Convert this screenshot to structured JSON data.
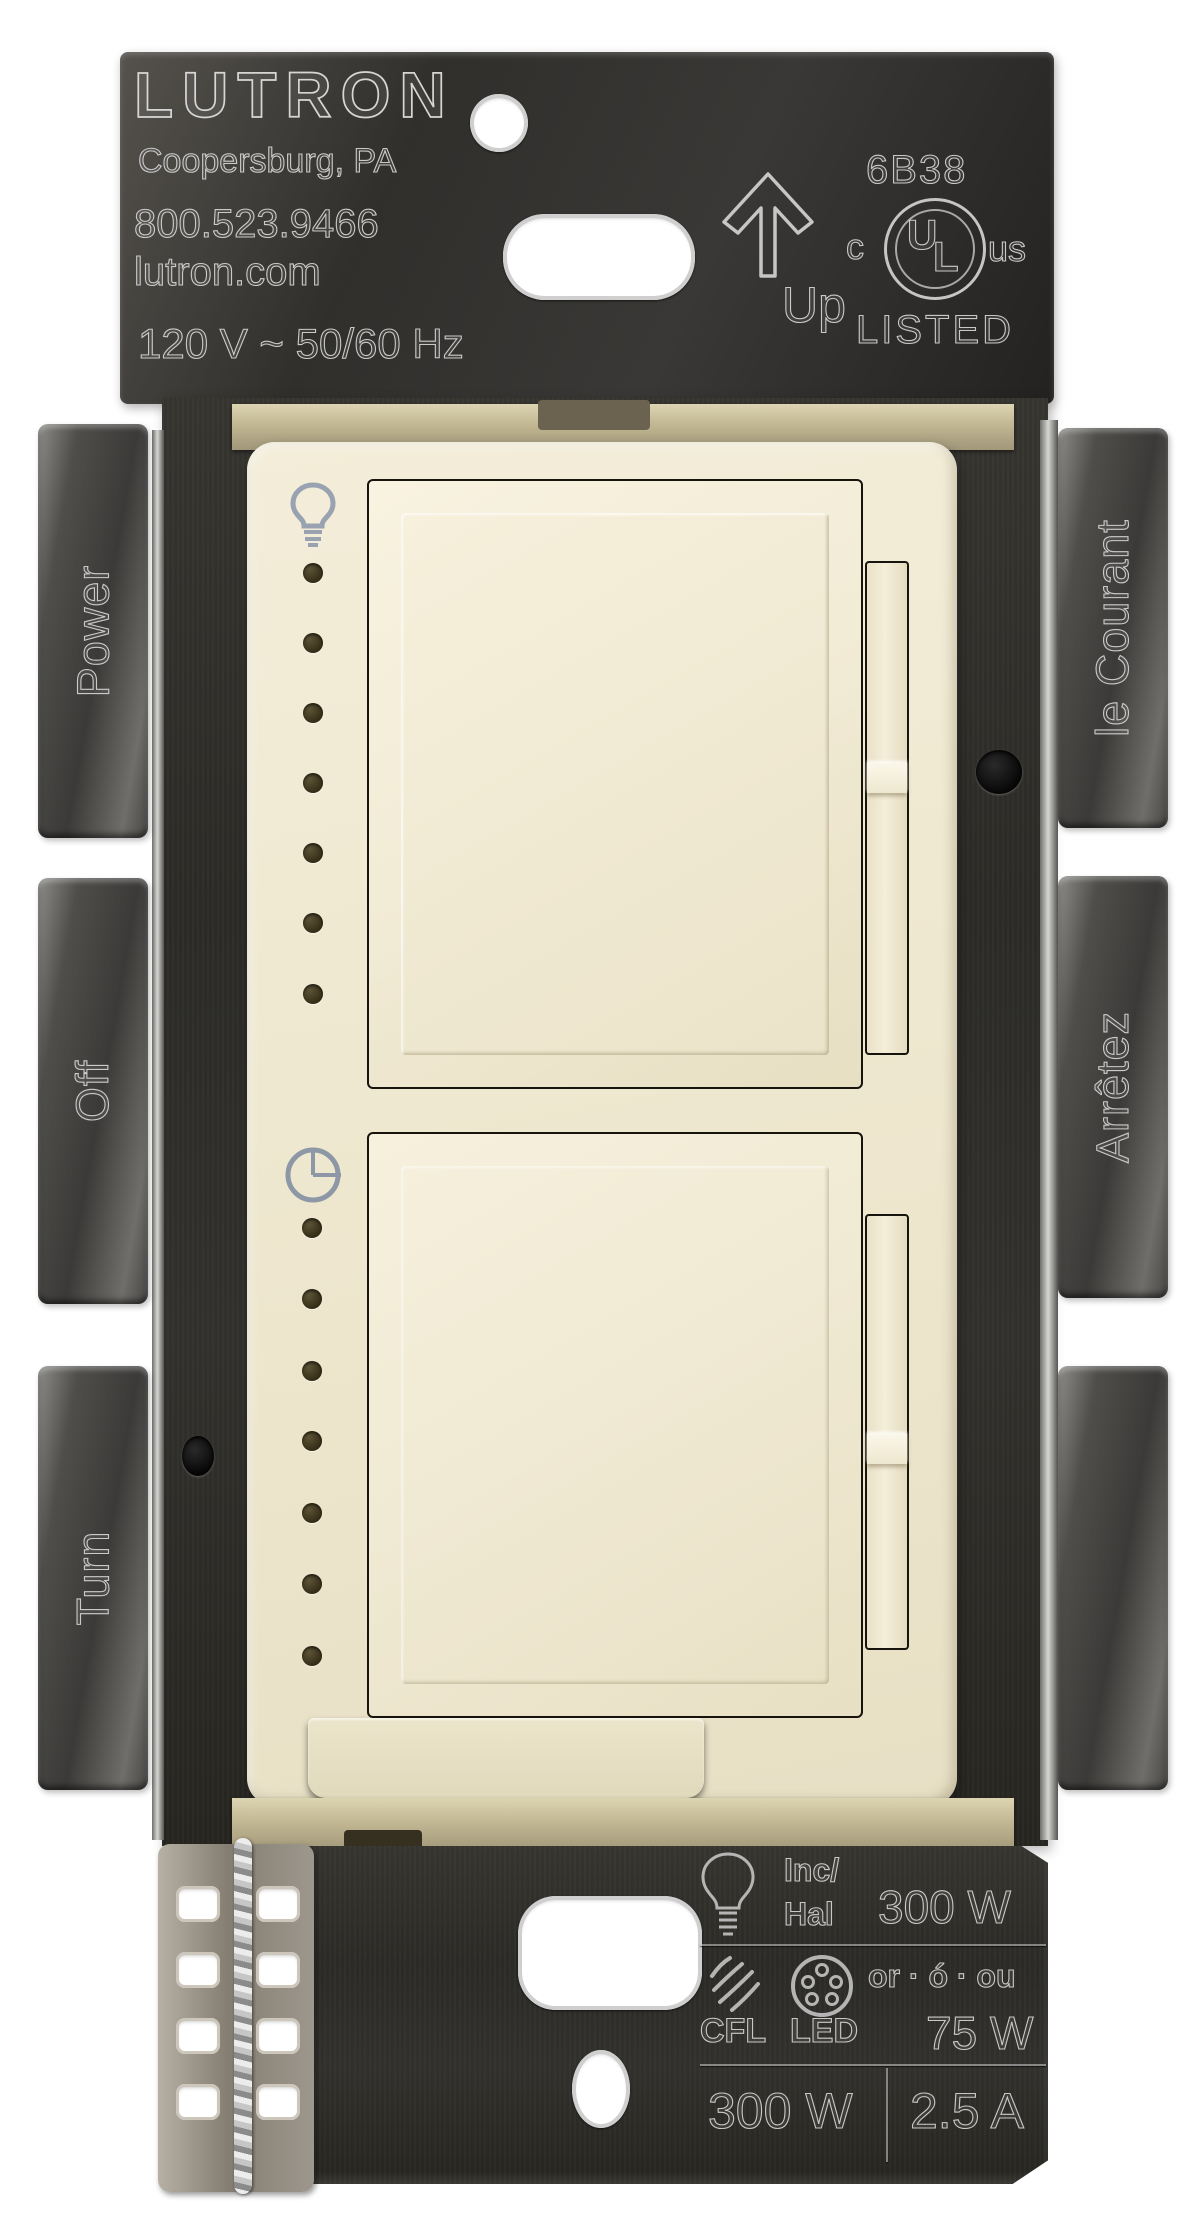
{
  "top_plate": {
    "brand": "LUTRON",
    "address": "Coopersburg, PA",
    "phone": "800.523.9466",
    "website": "lutron.com",
    "electrical_rating": "120 V ~ 50/60 Hz",
    "code": "6B38",
    "orientation_label": "Up",
    "ul_prefix": "c",
    "ul_u": "U",
    "ul_l": "L",
    "ul_suffix": "us",
    "listed": "LISTED"
  },
  "left_tabs": {
    "top": "Power",
    "middle": "Off",
    "bottom": "Turn"
  },
  "right_tabs": {
    "top": "le Courant",
    "middle": "Arrêtez"
  },
  "timer": {
    "labels": [
      "On",
      "60",
      "45",
      "30",
      "15",
      "10",
      "5"
    ]
  },
  "ratings_plate": {
    "inc_line1": "Inc/",
    "inc_line2": "Hal",
    "inc_hal_watts": "300 W",
    "or_text": "or · ó · ou",
    "cfl_label": "CFL",
    "led_label": "LED",
    "cfl_led_watts": "75 W",
    "total_watts": "300 W",
    "max_amps": "2.5 A"
  },
  "icons": {
    "up_arrow": "up-arrow-icon",
    "light_bulb": "light-bulb-icon",
    "timer_clock": "timer-clock-icon",
    "inc_hal_bulb": "incandescent-bulb-icon",
    "cfl": "cfl-squiggle-icon",
    "led_module": "led-module-icon"
  },
  "colors": {
    "faceplate": "#efe8d0",
    "bracket_metal": "#2e2d29",
    "engraving": "#d6d6d6",
    "timer_label_text": "#96a0ae",
    "indicator_dot": "#3f371f"
  }
}
